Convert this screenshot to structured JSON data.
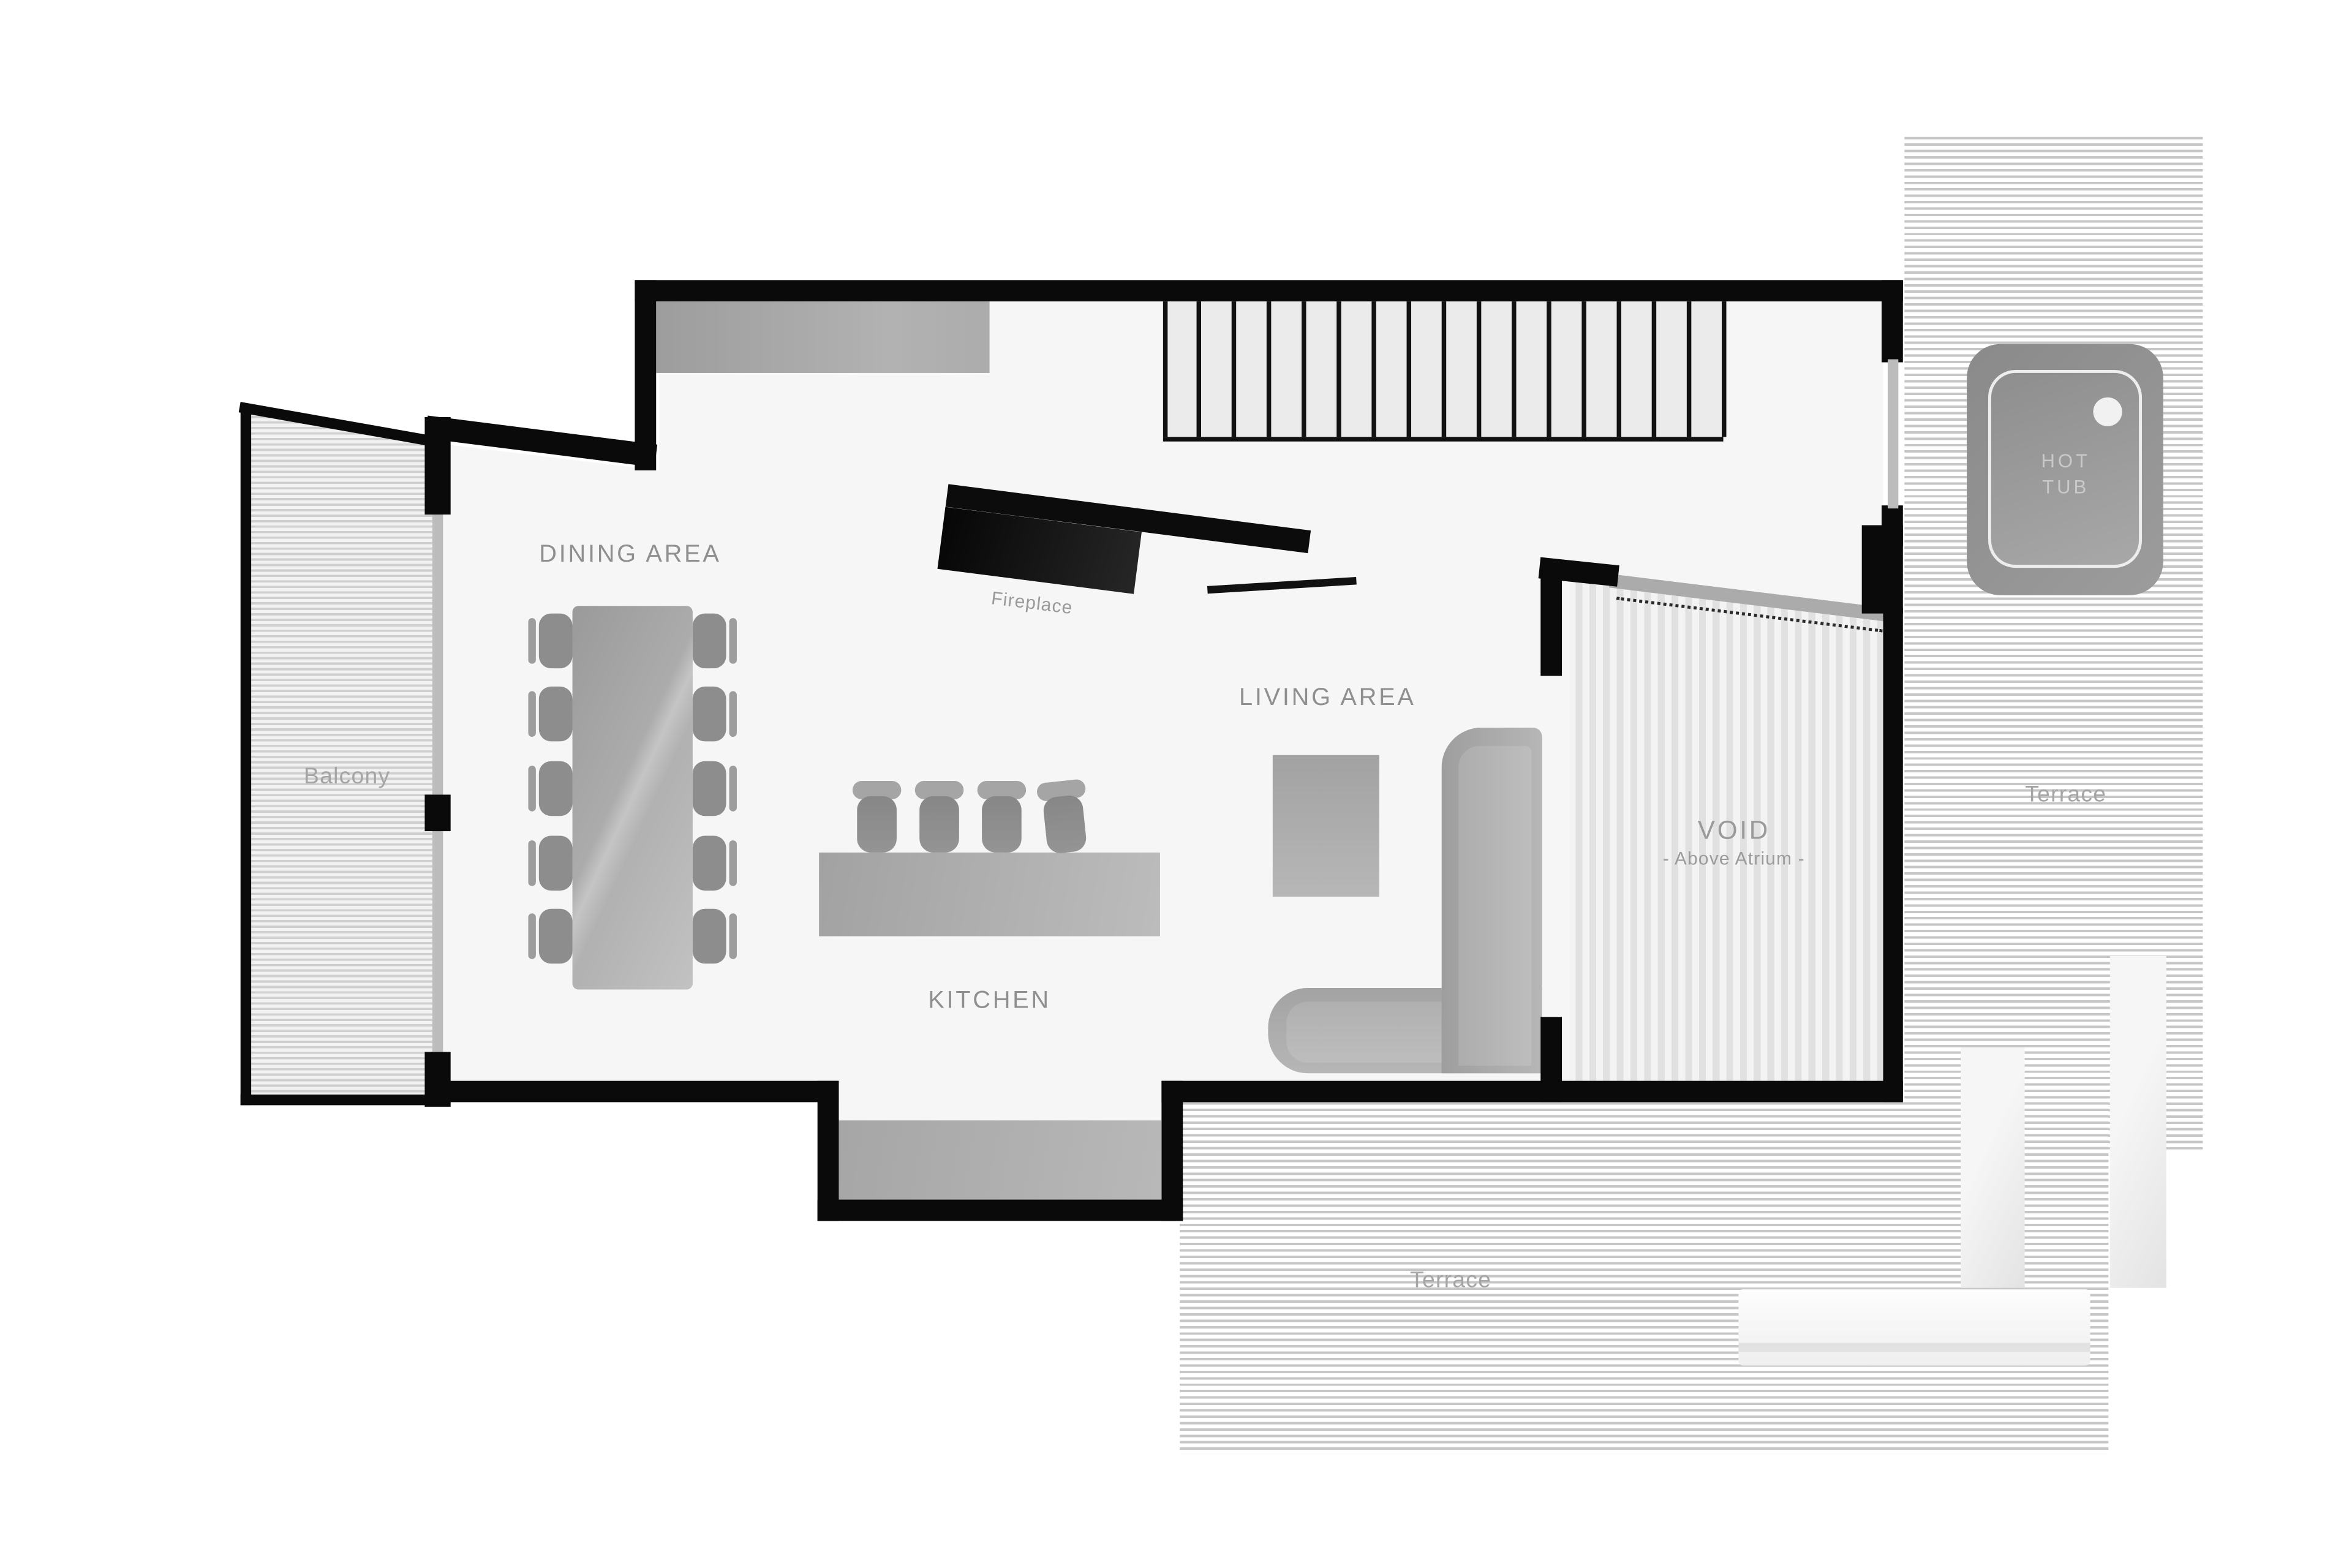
{
  "plan": {
    "type": "floor-plan",
    "labels": {
      "dining": "DINING AREA",
      "kitchen": "KITCHEN",
      "living": "LIVING AREA",
      "void_title": "VOID",
      "void_sub": "- Above Atrium -",
      "balcony": "Balcony",
      "terrace_right": "Terrace",
      "terrace_bottom": "Terrace",
      "fireplace": "Fireplace",
      "hot_tub_line1": "HOT",
      "hot_tub_line2": "TUB"
    },
    "colors": {
      "wall": "#0a0a0a",
      "floor": "#f6f6f6",
      "hatch_line": "#c6c6c6",
      "void_stripe": "#e1e1e1",
      "label_text": "#8f8f8f",
      "window": "#bcbcbc",
      "furniture_gray": "#a8a8a8",
      "hot_tub_gray": "#909090"
    },
    "furniture": {
      "dining_chairs": 10,
      "bar_stools": 4,
      "stair_tread_lines": 17,
      "planters": 2,
      "benches": 1
    }
  }
}
